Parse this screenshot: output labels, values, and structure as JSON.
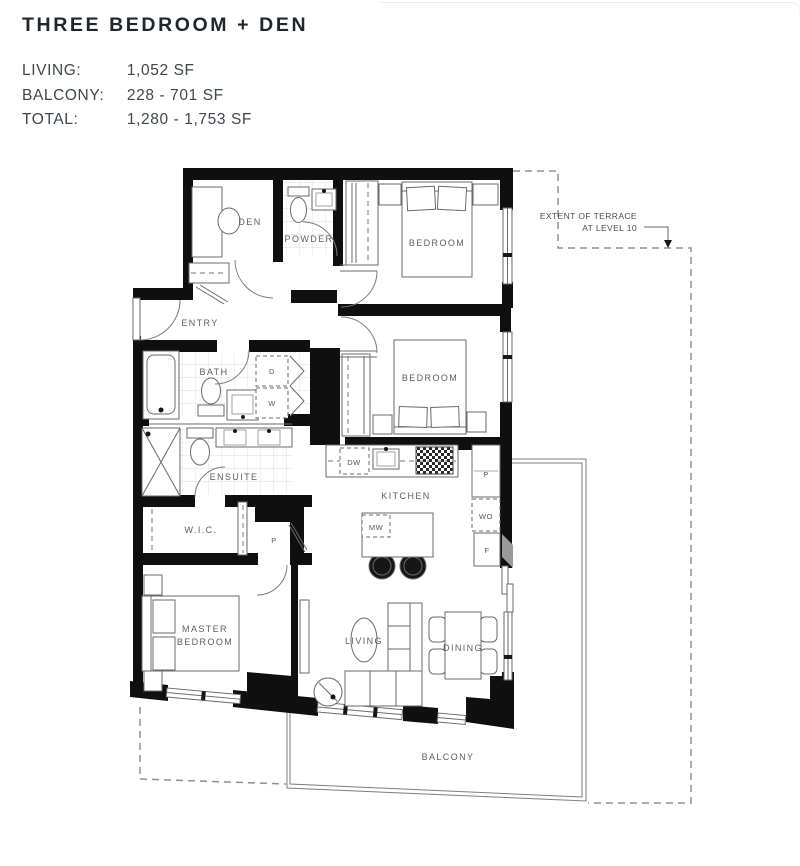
{
  "header": {
    "title": "THREE BEDROOM + DEN"
  },
  "stats": {
    "rows": [
      {
        "label": "LIVING:",
        "value": "1,052 SF"
      },
      {
        "label": "BALCONY:",
        "value": "228 - 701 SF"
      },
      {
        "label": "TOTAL:",
        "value": "1,280 - 1,753 SF"
      }
    ]
  },
  "plan": {
    "labels": {
      "den": "DEN",
      "powder": "POWDER",
      "entry": "ENTRY",
      "bedroom1": "BEDROOM",
      "bedroom2": "BEDROOM",
      "bath": "BATH",
      "ensuite": "ENSUITE",
      "wic": "W.I.C.",
      "master_line1": "MASTER",
      "master_line2": "BEDROOM",
      "kitchen": "KITCHEN",
      "living": "LIVING",
      "dining": "DINING",
      "balcony": "BALCONY",
      "dryer": "D",
      "washer": "W",
      "dishwasher": "DW",
      "microwave": "MW",
      "pantry": "P",
      "wall_oven": "WO",
      "fridge": "F",
      "hall_closet": "P"
    },
    "annotation": {
      "line1": "EXTENT OF TERRACE",
      "line2": "AT LEVEL 10"
    },
    "colors": {
      "wall": "#0f0f0f",
      "line": "#6a6a6a",
      "label": "#5e5e5e",
      "dashed_outline": "#909090",
      "title": "#20252e",
      "stats_text": "#40454f"
    }
  }
}
